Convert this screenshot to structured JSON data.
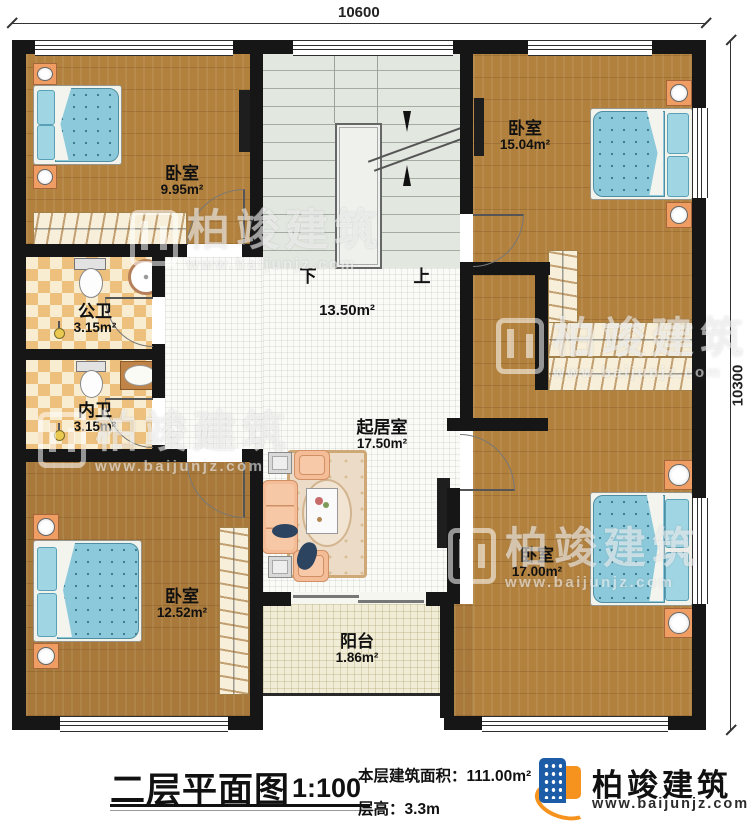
{
  "plan": {
    "dim_top": "10600",
    "dim_right": "10300",
    "stair_down": "下",
    "stair_up": "上"
  },
  "rooms": [
    {
      "name": "卧室",
      "area": "9.95m²"
    },
    {
      "name": "卧室",
      "area": "15.04m²"
    },
    {
      "name": "公卫",
      "area": "3.15m²"
    },
    {
      "name": "内卫",
      "area": "3.15m²"
    },
    {
      "name": "",
      "area": "13.50m²"
    },
    {
      "name": "起居室",
      "area": "17.50m²"
    },
    {
      "name": "卧室",
      "area": "12.52m²"
    },
    {
      "name": "卧室",
      "area": "17.00m²"
    },
    {
      "name": "阳台",
      "area": "1.86m²"
    }
  ],
  "title_block": {
    "title": "二层平面图",
    "scale": "1:100",
    "area_label": "本层建筑面积：",
    "area_value": "111.00m²",
    "floor_height_label": "层高：",
    "floor_height_value": "3.3m"
  },
  "brand": {
    "name": "柏竣建筑",
    "website": "www.baijunjz.com"
  },
  "watermark": {
    "name": "柏竣建筑",
    "website": "www.baijunjz.com"
  }
}
